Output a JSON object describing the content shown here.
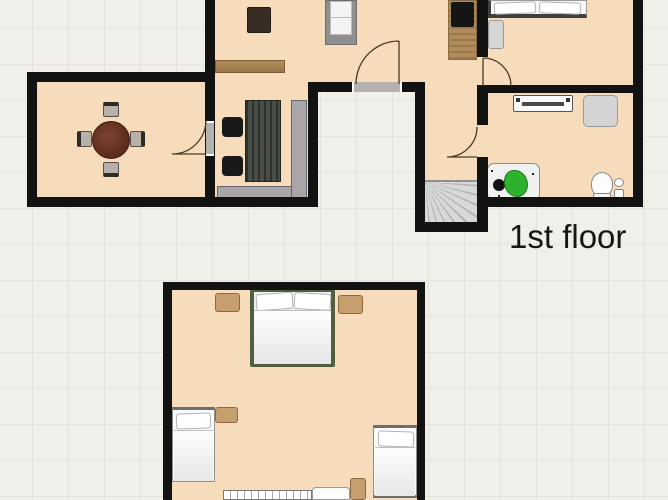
{
  "first_floor": {
    "label": "1st floor",
    "rooms": [
      {
        "name": "dining-room",
        "furniture": [
          "round-dining-table",
          "dining-chair x4"
        ]
      },
      {
        "name": "living-kitchen",
        "furniture": [
          "sofa",
          "tv-stand",
          "sideboard",
          "work-table",
          "black-chair x2",
          "corner-bench",
          "kitchen-counter",
          "cooktop"
        ]
      },
      {
        "name": "hallway",
        "furniture": [
          "staircase-down"
        ]
      },
      {
        "name": "bedroom",
        "furniture": [
          "double-bed",
          "bedside-cabinet"
        ]
      },
      {
        "name": "bathroom",
        "furniture": [
          "radiator",
          "shower-cabinet",
          "washing-machine",
          "green-stool",
          "toilet",
          "sink"
        ]
      }
    ],
    "doors": [
      "dining-door",
      "entrance-door",
      "bedroom-door",
      "bathroom-door"
    ]
  },
  "second_floor": {
    "rooms": [
      {
        "name": "attic-bedroom",
        "furniture": [
          "double-bed",
          "nightstand x4",
          "single-bed x2",
          "staircase",
          "stair-landing"
        ]
      }
    ]
  },
  "palette": {
    "background": "#f1efe9",
    "grid_line": "#e6e3dc",
    "floor_fill": "#f6dcbb",
    "wall": "#121212",
    "wood_light": "#c79e6e",
    "wood_mid": "#a88054",
    "desk_dark": "#3f453e",
    "dining_table": "#6b3a28",
    "sofa_gray": "#aaa5a8",
    "appliance_green": "#2eb22e",
    "bed_frame_green": "#51603c",
    "door_arc": "#4b3a26"
  }
}
